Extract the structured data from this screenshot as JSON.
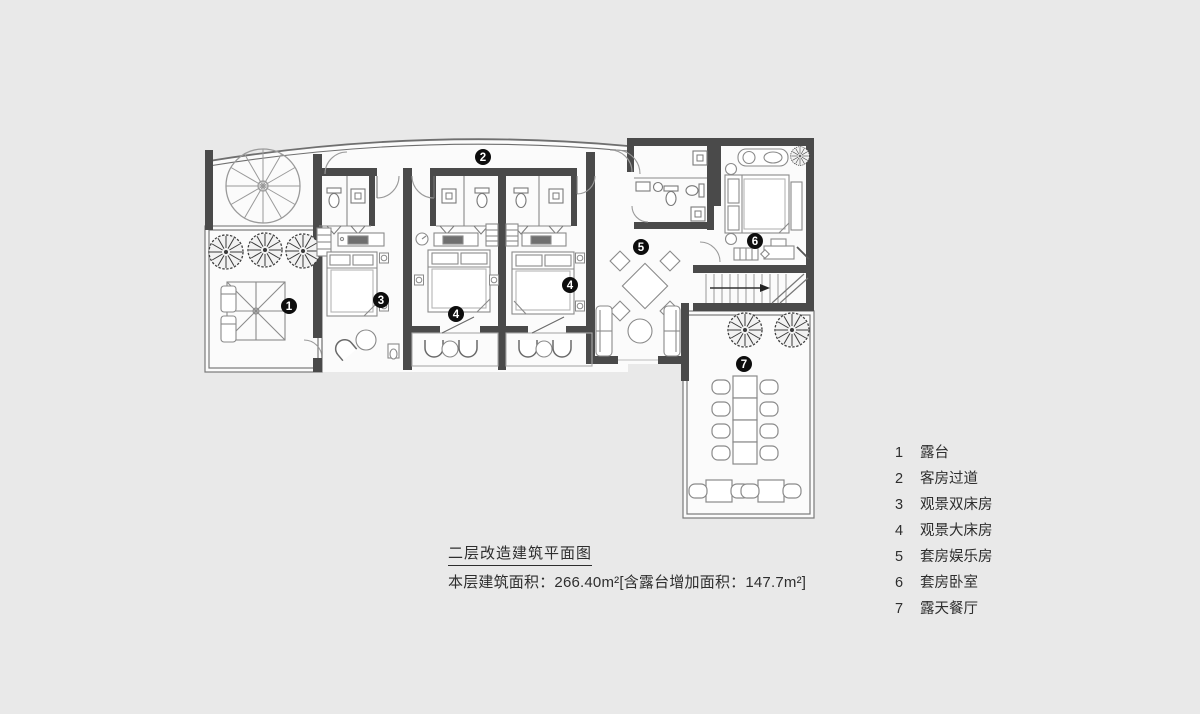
{
  "page": {
    "background": "#e9e9e9"
  },
  "plan": {
    "colors": {
      "wall": "#4a4a4a",
      "furniture_line": "#8a8a8a",
      "room_fill": "#fbfbfb",
      "marker": "#0d0d0d"
    },
    "markers": [
      {
        "num": "1",
        "room": "露台"
      },
      {
        "num": "2",
        "room": "客房过道"
      },
      {
        "num": "3",
        "room": "观景双床房"
      },
      {
        "num": "4",
        "room": "观景大床房"
      },
      {
        "num": "4",
        "room": "观景大床房"
      },
      {
        "num": "5",
        "room": "套房娱乐房"
      },
      {
        "num": "6",
        "room": "套房卧室"
      },
      {
        "num": "7",
        "room": "露天餐厅"
      }
    ]
  },
  "legend": {
    "items": [
      {
        "num": "1",
        "label": "露台"
      },
      {
        "num": "2",
        "label": "客房过道"
      },
      {
        "num": "3",
        "label": "观景双床房"
      },
      {
        "num": "4",
        "label": "观景大床房"
      },
      {
        "num": "5",
        "label": "套房娱乐房"
      },
      {
        "num": "6",
        "label": "套房卧室"
      },
      {
        "num": "7",
        "label": "露天餐厅"
      }
    ]
  },
  "title_block": {
    "line1": "二层改造建筑平面图",
    "line2": "本层建筑面积：266.40m²[含露台增加面积：147.7m²]"
  }
}
